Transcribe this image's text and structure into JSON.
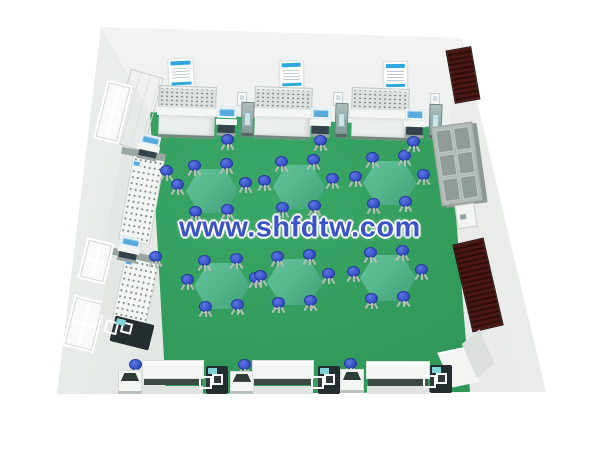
{
  "watermark": {
    "text": "www.shfdtw.com",
    "color": "#3a53c8"
  },
  "colors": {
    "back_wall_top": "#f3f5f3",
    "back_wall_bottom": "#dfe4e1",
    "left_wall_light": "#f0f3f1",
    "left_wall_dark": "#c8d0cc",
    "right_wall_light": "#f1f3f1",
    "right_wall_dark": "#d8ddd9",
    "floor_light": "#3aa767",
    "floor_dark": "#2b9152",
    "table_top": "#56b68e",
    "table_edge": "#41a078",
    "stool_blue": "#3a54c9",
    "stool_rim": "#28399f",
    "bench_white": "#f4f6f4",
    "bench_panel": "#dde2df",
    "panel_dot": "#6d7d76",
    "base_line": "#74897e",
    "poster_blue": "#2ea7de",
    "screen_blue": "#58aadd",
    "stand_teal": "#7e9694",
    "maroon": "#4a1712",
    "maroon_dark": "#2d0d08",
    "cabinet_gray": "#b2bbb6",
    "cabinet_cell": "#8f9c97",
    "dark_stand": "#242c2f"
  },
  "scene": {
    "posters": [
      {
        "x": 168,
        "y": 58,
        "w": 26,
        "h": 30,
        "r": -3
      },
      {
        "x": 279,
        "y": 60,
        "w": 25,
        "h": 29,
        "r": -2
      },
      {
        "x": 383,
        "y": 61,
        "w": 25,
        "h": 29,
        "r": -1
      }
    ],
    "wall_boxes": [
      {
        "x": 237,
        "y": 92,
        "w": 10,
        "h": 14,
        "r": 2
      },
      {
        "x": 333,
        "y": 92,
        "w": 10,
        "h": 14,
        "r": 2
      },
      {
        "x": 430,
        "y": 93,
        "w": 10,
        "h": 14,
        "r": 2
      }
    ],
    "back_benches": [
      {
        "x": 158,
        "y": 86,
        "w": 58,
        "h": 52,
        "r": 2
      },
      {
        "x": 254,
        "y": 87,
        "w": 58,
        "h": 52,
        "r": 2
      },
      {
        "x": 351,
        "y": 88,
        "w": 58,
        "h": 52,
        "r": 2
      }
    ],
    "back_trolleys": [
      {
        "x": 216,
        "y": 106,
        "w": 21,
        "h": 30,
        "r": 2
      },
      {
        "x": 310,
        "y": 107,
        "w": 21,
        "h": 30,
        "r": 2
      },
      {
        "x": 404,
        "y": 108,
        "w": 21,
        "h": 30,
        "r": 2
      }
    ],
    "back_stands": [
      {
        "x": 241,
        "y": 102,
        "w": 13,
        "h": 35,
        "r": 2
      },
      {
        "x": 335,
        "y": 103,
        "w": 13,
        "h": 35,
        "r": 2
      },
      {
        "x": 429,
        "y": 104,
        "w": 13,
        "h": 35,
        "r": 2
      }
    ],
    "corner_cabinet": {
      "x": 120,
      "y": 72,
      "w": 34,
      "h": 76,
      "r": 16
    },
    "windows": [
      {
        "x": 100,
        "y": 82,
        "w": 26,
        "h": 60,
        "r": 14
      },
      {
        "x": 82,
        "y": 240,
        "w": 28,
        "h": 42,
        "r": 14
      },
      {
        "x": 68,
        "y": 298,
        "w": 32,
        "h": 52,
        "r": 14
      }
    ],
    "left_benches": [
      {
        "x": 114,
        "y": 150,
        "w": 44,
        "h": 92,
        "r": 10
      },
      {
        "x": 106,
        "y": 252,
        "w": 48,
        "h": 68,
        "r": 12
      }
    ],
    "left_trolleys": [
      {
        "x": 138,
        "y": 134,
        "w": 22,
        "h": 26,
        "r": 12
      },
      {
        "x": 118,
        "y": 236,
        "w": 22,
        "h": 26,
        "r": 12
      }
    ],
    "left_dark_stand": {
      "x": 112,
      "y": 320,
      "w": 40,
      "h": 26,
      "r": 14
    },
    "right_cabinet": {
      "x": 436,
      "y": 124,
      "w": 42,
      "h": 80,
      "r": -8,
      "cols": 2,
      "rows": 3
    },
    "right_small_box": {
      "x": 456,
      "y": 204,
      "w": 20,
      "h": 24,
      "r": -8
    },
    "maroon_panels": [
      {
        "x": 450,
        "y": 48,
        "w": 26,
        "h": 54,
        "r": -10
      },
      {
        "x": 462,
        "y": 240,
        "w": 32,
        "h": 90,
        "r": -13
      }
    ],
    "white_cube": {
      "x": 444,
      "y": 340,
      "w": 48,
      "h": 46,
      "r": -24
    },
    "bottom_podiums": [
      {
        "x": 118,
        "y": 370,
        "w": 24,
        "h": 24,
        "r": 0
      },
      {
        "x": 230,
        "y": 371,
        "w": 24,
        "h": 23,
        "r": 0
      },
      {
        "x": 340,
        "y": 369,
        "w": 24,
        "h": 24,
        "r": 0
      }
    ],
    "bottom_benches": [
      {
        "x": 142,
        "y": 360,
        "w": 62,
        "h": 34,
        "r": 0
      },
      {
        "x": 252,
        "y": 360,
        "w": 62,
        "h": 34,
        "r": 0
      },
      {
        "x": 366,
        "y": 361,
        "w": 64,
        "h": 33,
        "r": 0
      }
    ],
    "bottom_stands": [
      {
        "x": 206,
        "y": 366,
        "w": 22,
        "h": 28,
        "r": 0
      },
      {
        "x": 318,
        "y": 366,
        "w": 22,
        "h": 28,
        "r": 0
      },
      {
        "x": 430,
        "y": 365,
        "w": 22,
        "h": 28,
        "r": 0
      }
    ],
    "tables": [
      {
        "cx": 212,
        "cy": 191,
        "w": 52,
        "h": 44
      },
      {
        "cx": 299,
        "cy": 187,
        "w": 52,
        "h": 44
      },
      {
        "cx": 390,
        "cy": 183,
        "w": 54,
        "h": 44
      },
      {
        "cx": 222,
        "cy": 286,
        "w": 56,
        "h": 46
      },
      {
        "cx": 295,
        "cy": 282,
        "w": 56,
        "h": 46
      },
      {
        "cx": 388,
        "cy": 278,
        "w": 56,
        "h": 46
      }
    ],
    "stool_offsets": [
      [
        -17,
        -25
      ],
      [
        15,
        -27
      ],
      [
        -34,
        -6
      ],
      [
        34,
        -8
      ],
      [
        -16,
        21
      ],
      [
        16,
        19
      ]
    ],
    "extra_stools": [
      [
        167,
        171
      ],
      [
        156,
        257
      ],
      [
        136,
        365
      ],
      [
        245,
        365
      ],
      [
        351,
        364
      ],
      [
        228,
        140
      ],
      [
        321,
        141
      ],
      [
        414,
        142
      ]
    ]
  }
}
